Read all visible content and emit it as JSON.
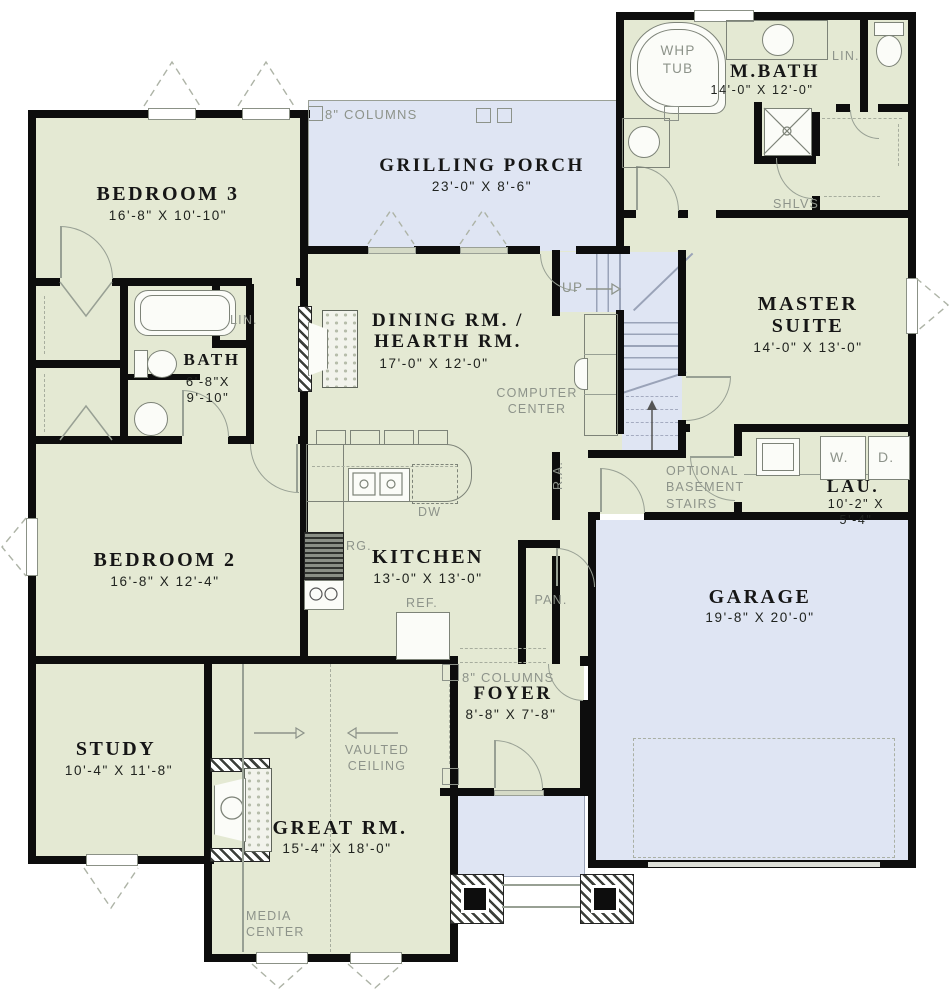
{
  "colors": {
    "room_fill": "#e4e9d3",
    "porch_fill": "#dfe5f3",
    "wall": "#0d0d0d",
    "annotation_text": "#8d938a",
    "label_text": "#161616",
    "line": "#98a094"
  },
  "rooms": {
    "bedroom3": {
      "name": "BEDROOM 3",
      "dims": "16'-8\" X 10'-10\""
    },
    "porch": {
      "name": "GRILLING PORCH",
      "dims": "23'-0\" X 8'-6\""
    },
    "mbath": {
      "name": "M.BATH",
      "dims": "14'-0\" X 12'-0\""
    },
    "master": {
      "name": "MASTER\nSUITE",
      "dims": "14'-0\" X 13'-0\""
    },
    "dining": {
      "name": "DINING RM. /\nHEARTH RM.",
      "dims": "17'-0\" X 12'-0\""
    },
    "bath": {
      "name": "BATH",
      "dims": "6'-8\"X\n9'-10\""
    },
    "bedroom2": {
      "name": "BEDROOM 2",
      "dims": "16'-8\" X 12'-4\""
    },
    "kitchen": {
      "name": "KITCHEN",
      "dims": "13'-0\" X 13'-0\""
    },
    "laundry": {
      "name": "LAU.",
      "dims": "10'-2\" X 5'-4\""
    },
    "garage": {
      "name": "GARAGE",
      "dims": "19'-8\" X 20'-0\""
    },
    "foyer": {
      "name": "FOYER",
      "dims": "8'-8\" X 7'-8\""
    },
    "study": {
      "name": "STUDY",
      "dims": "10'-4\" X 11'-8\""
    },
    "great": {
      "name": "GREAT RM.",
      "dims": "15'-4\" X 18'-0\""
    }
  },
  "annotations": {
    "porch_columns": "8\" COLUMNS",
    "foyer_columns": "8\" COLUMNS",
    "whp_tub": "WHP\nTUB",
    "lin_mbath": "LIN.",
    "lin_bath": "LIN.",
    "shelves": "SHLVS",
    "up": "UP",
    "computer_center": "COMPUTER\nCENTER",
    "optional_stairs": "OPTIONAL\nBASEMENT\nSTAIRS",
    "return_air": "R.A.",
    "range": "RG.",
    "dishwasher": "DW",
    "refrigerator": "REF.",
    "pantry": "PAN.",
    "washer": "W.",
    "dryer": "D.",
    "vaulted_ceiling": "VAULTED\nCEILING",
    "media_center": "MEDIA\nCENTER"
  }
}
